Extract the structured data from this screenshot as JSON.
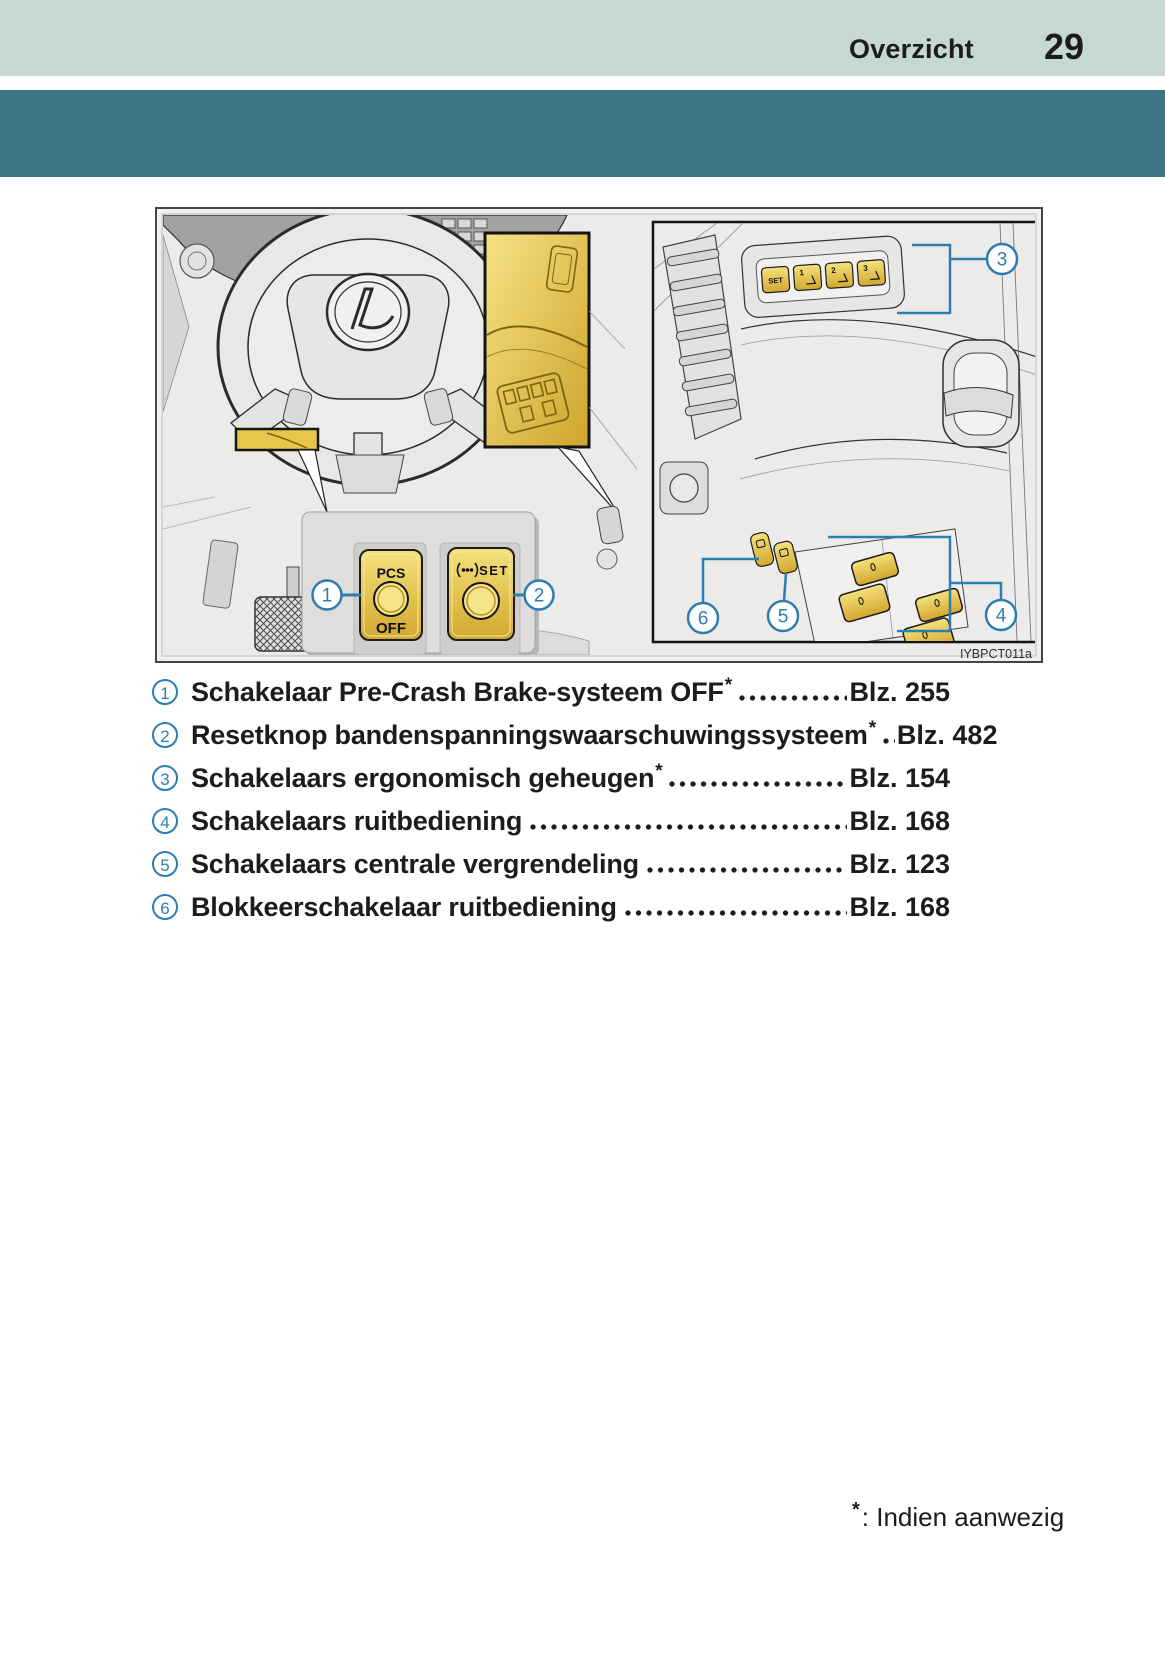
{
  "page": {
    "section_title": "Overzicht",
    "page_number": "29"
  },
  "colors": {
    "band_light": "#c5d8d4",
    "band_teal": "#3e7689",
    "accent_blue": "#2d7eb0",
    "highlight_yellow": "#e8c649",
    "text": "#1c1c1c"
  },
  "figure": {
    "caption": "IYBPCT011a",
    "callouts": [
      "1",
      "2",
      "3",
      "4",
      "5",
      "6"
    ],
    "labels": {
      "pcs_top": "PCS",
      "pcs_bottom": "OFF",
      "tpms_set": "SET",
      "memory_set": "SET",
      "memory_1": "1",
      "memory_2": "2",
      "memory_3": "3"
    }
  },
  "legend": {
    "items": [
      {
        "num": "1",
        "label": "Schakelaar Pre-Crash Brake-systeem OFF",
        "asterisk": "*",
        "page_ref": "Blz. 255"
      },
      {
        "num": "2",
        "label": "Resetknop bandenspanningswaarschuwingssysteem",
        "asterisk": "*",
        "page_ref": "Blz. 482"
      },
      {
        "num": "3",
        "label": "Schakelaars ergonomisch geheugen",
        "asterisk": "*",
        "page_ref": "Blz. 154"
      },
      {
        "num": "4",
        "label": "Schakelaars ruitbediening",
        "asterisk": "",
        "page_ref": "Blz. 168"
      },
      {
        "num": "5",
        "label": "Schakelaars centrale vergrendeling",
        "asterisk": "",
        "page_ref": "Blz. 123"
      },
      {
        "num": "6",
        "label": "Blokkeerschakelaar ruitbediening",
        "asterisk": "",
        "page_ref": "Blz. 168"
      }
    ]
  },
  "footnote": {
    "symbol": "*",
    "text": ": Indien aanwezig"
  }
}
